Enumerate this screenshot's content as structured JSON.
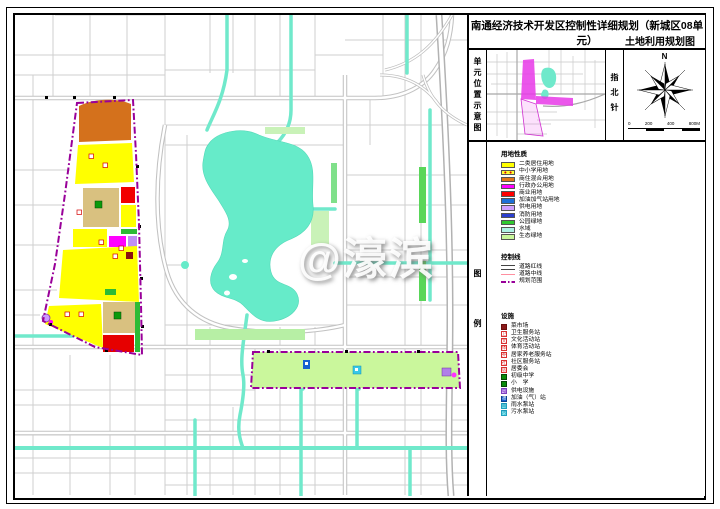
{
  "title_block": {
    "title": "南通经济技术开发区控制性详细规划（新城区08单元）",
    "subtitle": "土地利用规划图"
  },
  "panel": {
    "location_label": "单元位置示意图",
    "compass_label": "指北针",
    "legend_label": "图例",
    "north": "N"
  },
  "scale_bar": {
    "labels": [
      "0",
      "200",
      "400",
      "800M"
    ]
  },
  "legend": {
    "landuse": {
      "header": "用地性质",
      "items": [
        {
          "label": "二类居住用地",
          "color": "#ffff00"
        },
        {
          "label": "中小学用地",
          "color": "#ffff33",
          "pattern": "dots"
        },
        {
          "label": "商住混合用地",
          "color": "#e0761a"
        },
        {
          "label": "行政办公用地",
          "color": "#ff00ff"
        },
        {
          "label": "商业用地",
          "color": "#ff0000"
        },
        {
          "label": "加油加气站用地",
          "color": "#1d6fd6"
        },
        {
          "label": "供电用地",
          "color": "#cfa0ff"
        },
        {
          "label": "消防用地",
          "color": "#2b3fd0"
        },
        {
          "label": "公园绿地",
          "color": "#2fc82f"
        },
        {
          "label": "水域",
          "color": "#aef3e4"
        },
        {
          "label": "生态绿地",
          "color": "#c9f79b"
        }
      ]
    },
    "control": {
      "header": "控制线",
      "items": [
        {
          "label": "道路红线",
          "style": "road"
        },
        {
          "label": "道路中线",
          "style": "center"
        },
        {
          "label": "规划范围",
          "style": "boundary"
        }
      ]
    },
    "facilities": {
      "header": "设施",
      "items": [
        {
          "label": "菜市场",
          "fill": "#8b1a1a",
          "border": "#6b0f0f",
          "glyph": "",
          "glyphColor": "#fff"
        },
        {
          "label": "卫生服务站",
          "fill": "#ffffff",
          "border": "#d93030",
          "glyph": "卫",
          "glyphColor": "#d93030"
        },
        {
          "label": "文化活动站",
          "fill": "#ffffff",
          "border": "#d93030",
          "glyph": "文",
          "glyphColor": "#d93030"
        },
        {
          "label": "体育活动站",
          "fill": "#ffffff",
          "border": "#d93030",
          "glyph": "体",
          "glyphColor": "#d93030"
        },
        {
          "label": "居家养老服务站",
          "fill": "#ffffff",
          "border": "#d93030",
          "glyph": "养",
          "glyphColor": "#d93030"
        },
        {
          "label": "社区服务站",
          "fill": "#ffffff",
          "border": "#d93030",
          "glyph": "社",
          "glyphColor": "#d93030"
        },
        {
          "label": "居委会",
          "fill": "#ffffff",
          "border": "#d93030",
          "glyph": "居",
          "glyphColor": "#d93030"
        },
        {
          "label": "初级中学",
          "fill": "#0a8a0a",
          "border": "#064406",
          "glyph": "",
          "glyphColor": "#fff"
        },
        {
          "label": "小　学",
          "fill": "#0a8a0a",
          "border": "#064406",
          "glyph": "",
          "glyphColor": "#fff"
        },
        {
          "label": "供电设施",
          "fill": "#d9b3ff",
          "border": "#8040c0",
          "glyph": "电",
          "glyphColor": "#6020a0"
        },
        {
          "label": "加油（气）站",
          "fill": "#1560d0",
          "border": "#0b3f90",
          "glyph": "油",
          "glyphColor": "#ffffff"
        },
        {
          "label": "雨水泵站",
          "fill": "#7fe8f0",
          "border": "#20a0c0",
          "glyph": "雨",
          "glyphColor": "#0878a0"
        },
        {
          "label": "污水泵站",
          "fill": "#7fe8f0",
          "border": "#20a0c0",
          "glyph": "污",
          "glyphColor": "#0878a0"
        }
      ]
    }
  },
  "watermark": "@濠滨"
}
